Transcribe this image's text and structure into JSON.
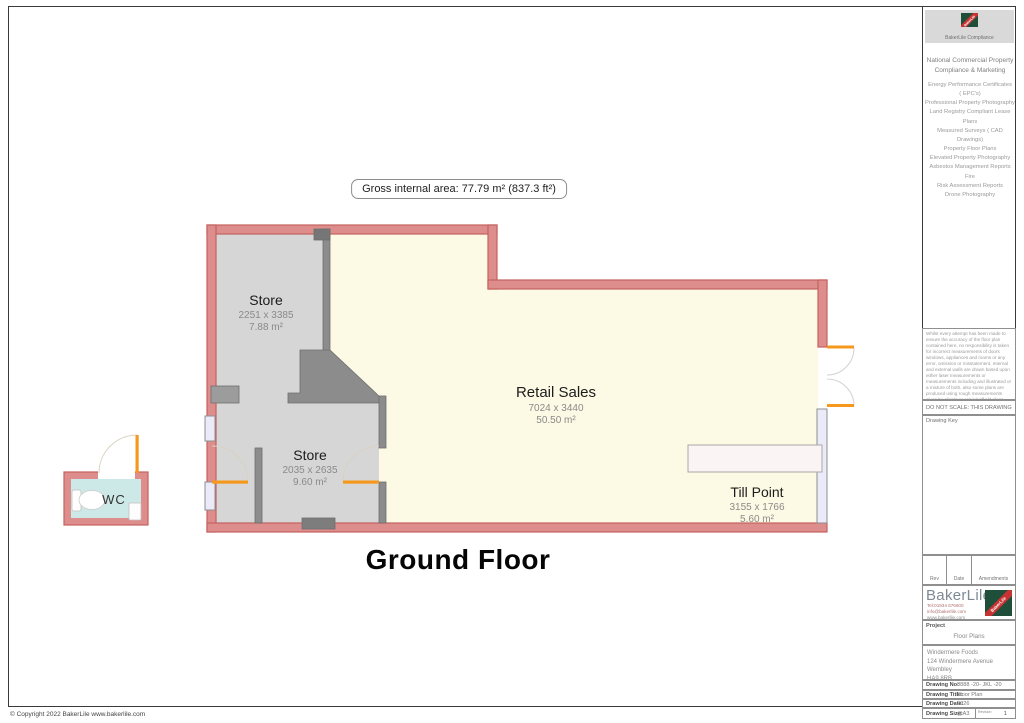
{
  "page": {
    "copyright": "© Copyright 2022 BakerLile  www.bakerlile.com"
  },
  "floor_plan": {
    "gross_area": "Gross internal area: 77.79 m² (837.3 ft²)",
    "title": "Ground Floor",
    "rooms": [
      {
        "name": "Store",
        "dims": "2251 x 3385",
        "area": "7.88 m²"
      },
      {
        "name": "Store",
        "dims": "2035 x 2635",
        "area": "9.60 m²"
      },
      {
        "name": "Retail Sales",
        "dims": "7024 x 3440",
        "area": "50.50 m²"
      },
      {
        "name": "Till Point",
        "dims": "3155 x 1766",
        "area": "5.60 m²"
      },
      {
        "name": "WC"
      }
    ]
  },
  "sidebar": {
    "compliance": {
      "logo_text": "BakerLile",
      "caption": "BakerLile Compliance"
    },
    "services_header": "National Commercial Property Compliance & Marketing",
    "services": [
      "Energy Performance Certificates",
      "( EPC's)",
      "Professional Property Photography",
      "Land Registry Compliant Lease Plans",
      "Measured Surveys ( CAD Drawings)",
      "Property Floor Plans",
      "Elevated Property Photography",
      "Asbestos Management Reports Fire",
      "Risk Assessment Reports",
      "Drone Photography"
    ],
    "disclaimer": "Whilst every attempt has been made to ensure the accuracy of the floor plan contained here, no responsibility is taken for incorrect measurements of doors windows, appliances and rooms or any error, omission or misstatement. Internal and external walls are drawn based upon either laser measurements or measurements including and illustrated or a mixture of both, also some plans are produced using rough measurements given by clients or copied off old plans. Any figure given is for initial guidance only and should not be relied on as a basis of valuation. These plans are for marketing purposes only and should be used as such by any prospective purchaser or other interested party. Specifically no guarantee is given on the total square footage of the property if quoted on this plan. If full measured areas and GIA plans are required for this building please contact us www.bakerlile.com",
    "do_not_scale": "DO NOT SCALE: THIS DRAWING",
    "drawing_key": "Drawing Key",
    "rev_table": {
      "rev": "Rev",
      "date": "Date",
      "amendments": "Amendments"
    },
    "company": {
      "name": "BakerLile",
      "tel": "Tel:01934 676600",
      "email": "info@bakerlile.com",
      "web": "www.bakerlile.com",
      "logo_text": "BakerLile"
    },
    "project": {
      "label": "Project",
      "value": "Floor Plans"
    },
    "client": {
      "line1": "Windermere Foods",
      "line2": "124 Windermere Avenue",
      "line3": "Wembley",
      "line4": "HA9 8RB"
    },
    "drawing_no": {
      "label": "Drawing No:",
      "value": "8888 -20- JKL -20"
    },
    "drawing_title": {
      "label": "Drawing Title:",
      "value": "Floor Plan"
    },
    "drawing_date": {
      "label": "Drawing Date:",
      "value": "2026"
    },
    "drawing_size": {
      "label": "Drawing Size:",
      "value": "@A3",
      "revision_label": "Revision",
      "revision": "1"
    }
  },
  "colors": {
    "wall_fill": "#dd8e8c",
    "wall_stroke": "#c4625f",
    "store_floor": "#d6d6d6",
    "retail_floor": "#fcf9e4",
    "internal_wall": "#8c8c8c",
    "window_fill": "#eaeaf8",
    "door_orange": "#f5991e",
    "wc_floor": "#cde9e7",
    "logo_green": "#1f4f3a",
    "logo_red": "#c63332"
  }
}
